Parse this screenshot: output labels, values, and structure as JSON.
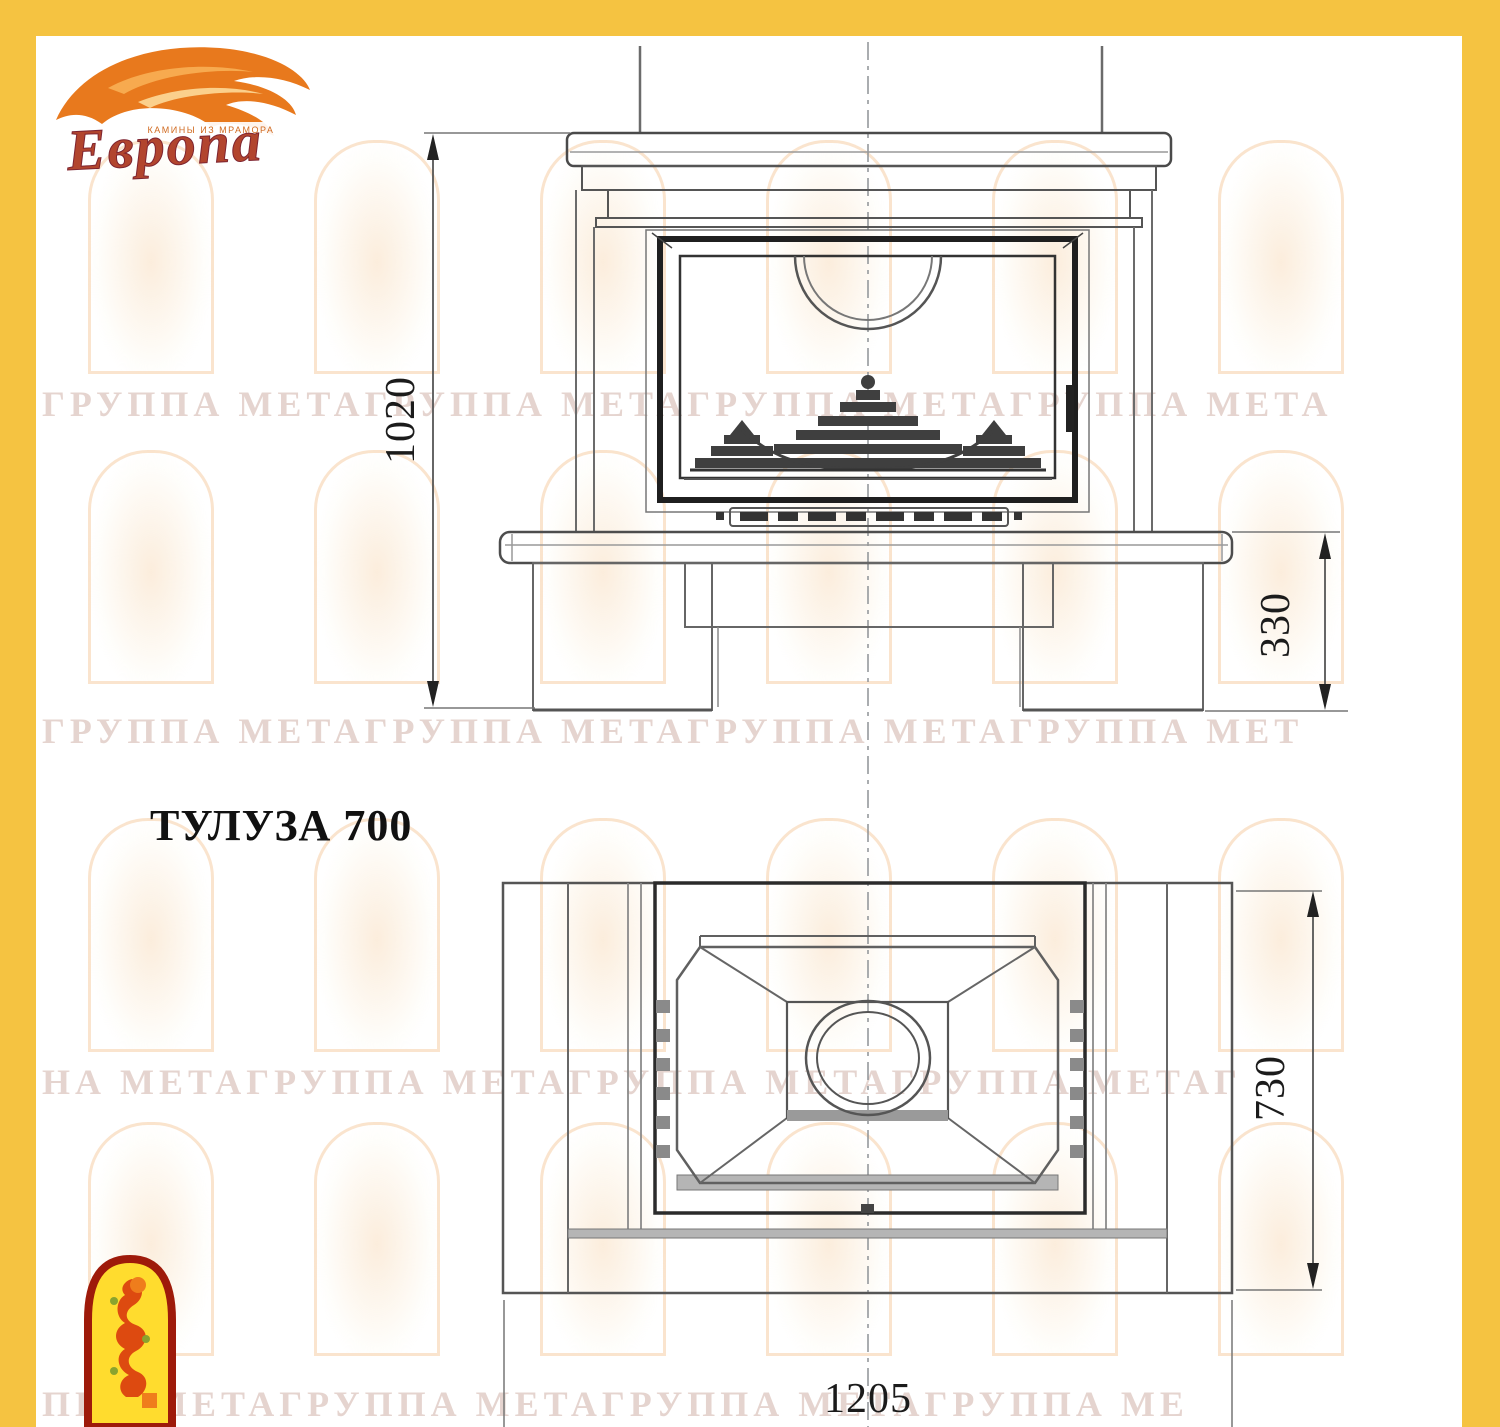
{
  "brand": {
    "name": "Европа",
    "tagline": "КАМИНЫ ИЗ МРАМОРА"
  },
  "title": {
    "model": "ТУЛУЗА 700"
  },
  "dims": {
    "front_height": "1020",
    "hearth_height": "330",
    "plan_depth": "730",
    "plan_width": "1205"
  },
  "watermark": {
    "rows": [
      "ГРУППА МЕТАГРУППА МЕТАГРУППА МЕТАГРУППА МЕТА",
      "ГРУППА МЕТАГРУППА МЕТАГРУППА МЕТАГРУППА МЕТ",
      "НА МЕТАГРУППА МЕТАГРУППА МЕТАГРУППА МЕТАГ",
      "ППА МЕТАГРУППА МЕТАГРУППА МЕТАГРУППА МЕ"
    ]
  }
}
